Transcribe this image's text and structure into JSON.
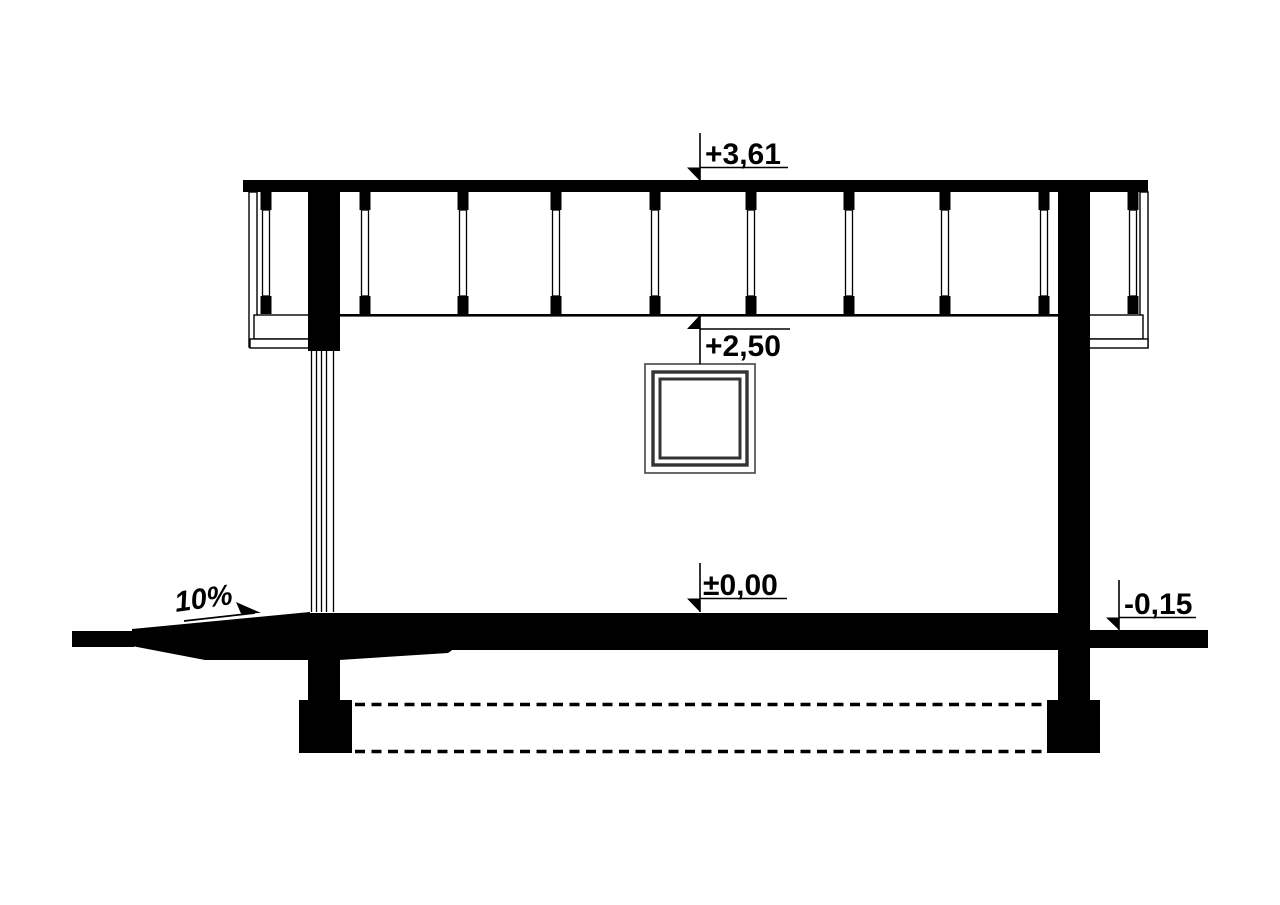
{
  "drawing": {
    "levels": {
      "roof": "+3,61",
      "ceiling": "+2,50",
      "floor": "±0,00",
      "ground": "-0,15"
    },
    "ramp_slope": "10%"
  }
}
